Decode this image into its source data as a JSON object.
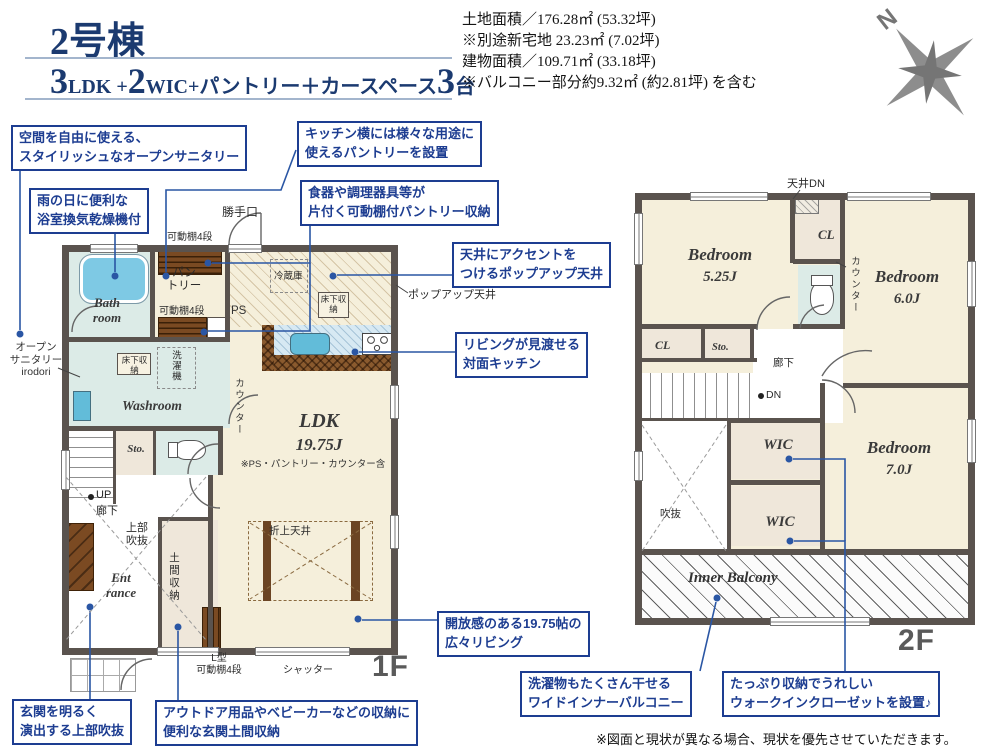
{
  "colors": {
    "accent_navy": "#1d3d91",
    "leader_blue": "#2a56a4",
    "wall": "#5a534e",
    "room_cream": "#f5efdb",
    "room_wet": "#dcebe7",
    "fixture_teal": "#7ec9e4",
    "wood_brown": "#7a4a22",
    "title_navy": "#1b3a70"
  },
  "header": {
    "unit": "2号棟",
    "layout_segments": [
      {
        "text": "3",
        "large": true
      },
      {
        "text": "LDK +",
        "large": false
      },
      {
        "text": "2",
        "large": true
      },
      {
        "text": "WIC+パントリー＋カースペース",
        "large": false
      },
      {
        "text": "3",
        "large": true
      },
      {
        "text": "台",
        "large": false
      }
    ],
    "info_lines": [
      "土地面積／176.28㎡ (53.32坪)",
      "※別途新宅地 23.23㎡ (7.02坪)",
      "建物面積／109.71㎡ (33.18坪)",
      "※バルコニー部分約9.32㎡ (約2.81坪) を含む"
    ],
    "compass_n": "N"
  },
  "callouts": [
    {
      "lines": [
        "空間を自由に使える、",
        "スタイリッシュなオープンサニタリー"
      ]
    },
    {
      "lines": [
        "雨の日に便利な",
        "浴室換気乾燥機付"
      ]
    },
    {
      "lines": [
        "キッチン横には様々な用途に",
        "使えるパントリーを設置"
      ]
    },
    {
      "lines": [
        "食器や調理器具等が",
        "片付く可動棚付パントリー収納"
      ]
    },
    {
      "lines": [
        "天井にアクセントを",
        "つけるポップアップ天井"
      ]
    },
    {
      "lines": [
        "リビングが見渡せる",
        "対面キッチン"
      ]
    },
    {
      "lines": [
        "玄関を明るく",
        "演出する上部吹抜"
      ]
    },
    {
      "lines": [
        "アウトドア用品やベビーカーなどの収納に",
        "便利な玄関土間収納"
      ]
    },
    {
      "lines": [
        "開放感のある19.75帖の",
        "広々リビング"
      ]
    },
    {
      "lines": [
        "洗濯物もたくさん干せる",
        "ワイドインナーバルコニー"
      ]
    },
    {
      "lines": [
        "たっぷり収納でうれしい",
        "ウォークインクローゼットを設置♪"
      ]
    }
  ],
  "plan1f": {
    "floor": "1F",
    "bath_l1": "Bath",
    "bath_l2": "room",
    "washroom": "Washroom",
    "pantry_l1": "パン",
    "pantry_l2": "トリー",
    "ps": "PS",
    "counter": "カウンター",
    "ldk": "LDK",
    "ldk_size": "19.75J",
    "ldk_note": "※PS・パントリー・カウンター含",
    "sto": "Sto.",
    "up": "UP",
    "hallway": "廊下",
    "void_l1": "上部",
    "void_l2": "吹抜",
    "ent_l1": "Ent",
    "ent_l2": "rance",
    "doma": "土間収納",
    "lshelf_l1": "L型",
    "lshelf_l2": "可動棚4段",
    "shutter": "シャッター",
    "coffered": "折上天井",
    "back_door": "勝手口",
    "shelf4": "可動棚4段",
    "fridge": "冷蔵庫",
    "underfloor": "床下収納",
    "washer": "洗濯機",
    "popup": "ポップアップ天井",
    "sanitary_l1": "オープン",
    "sanitary_l2": "サニタリー",
    "sanitary_l3": "irodori"
  },
  "plan2f": {
    "floor": "2F",
    "bedroom": "Bedroom",
    "b1_size": "5.25J",
    "b2_size": "6.0J",
    "b3_size": "7.0J",
    "wic": "WIC",
    "cl": "CL",
    "sto": "Sto.",
    "hallway": "廊下",
    "dn": "DN",
    "ceiling_dn": "天井DN",
    "counter": "カウンター",
    "void_label": "吹抜",
    "balcony": "Inner Balcony"
  },
  "disclaimer": "※図面と現状が異なる場合、現状を優先させていただきます。"
}
